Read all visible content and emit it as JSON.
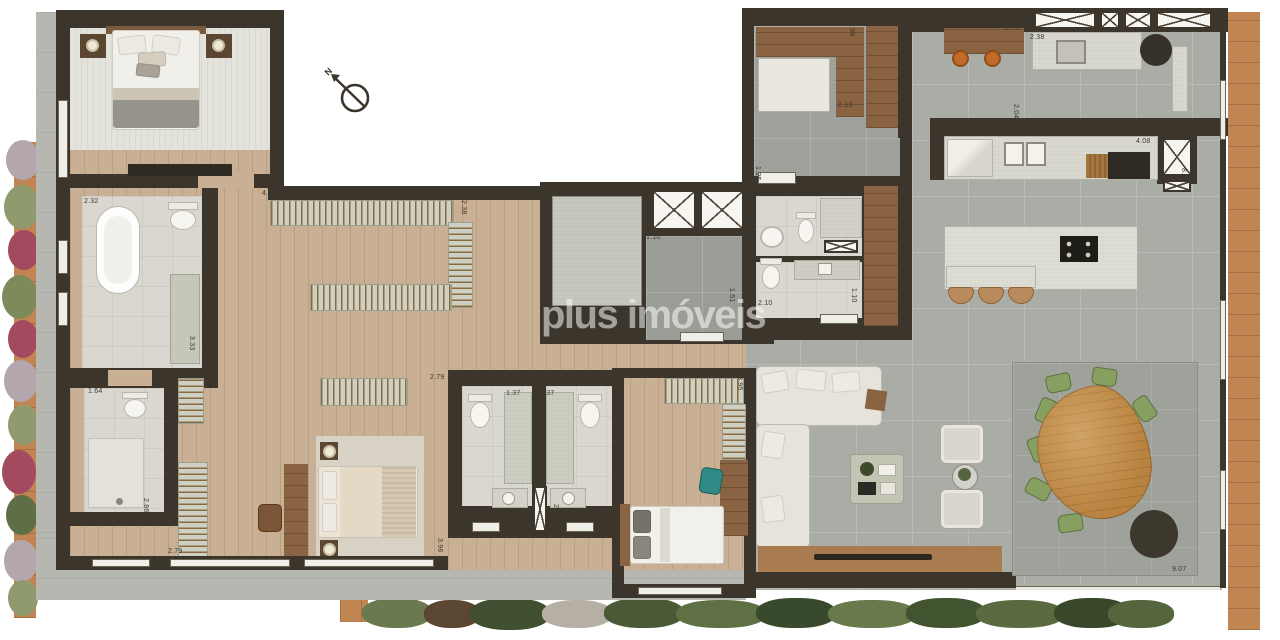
{
  "watermark": {
    "text": "plus imóveis"
  },
  "compass": {
    "label": "N"
  },
  "dims": [
    "4.15",
    "2.32",
    "3.33",
    "1.64",
    "2.86",
    "2.79",
    "4.07",
    "2.38",
    "1.10",
    "1.51",
    "1.12",
    "2.10",
    "2.10",
    "1.10",
    "2.79",
    "3.96",
    "1.37",
    "1.37",
    "2.71",
    "2.71",
    "3.95",
    "2.13",
    "1.98",
    "1.25",
    "2.04",
    "3.73",
    "2.38",
    "4.08",
    "8.35",
    "9.07"
  ],
  "colors": {
    "wall": "#3b352c",
    "woodFloor": "#c9af93",
    "tileGray": "#aaaca6",
    "bathTile": "#d9d7cf",
    "deck": "#c08552",
    "counter": "#d9d8ce",
    "sofa": "#e6e3da",
    "rackBase": "#cdd0c2",
    "hanger": "#8a6a3f",
    "tableWood": "#b8823f",
    "chairGreen": "#87a061",
    "teal": "#2f8a85",
    "stoolOrange": "#c06b28",
    "woodFurn": "#8a6342",
    "dark": "#2e2b24",
    "rug": "#d8d2c6",
    "lobbyGray": "#9a9d95",
    "terrace": "#b5b7b0"
  }
}
